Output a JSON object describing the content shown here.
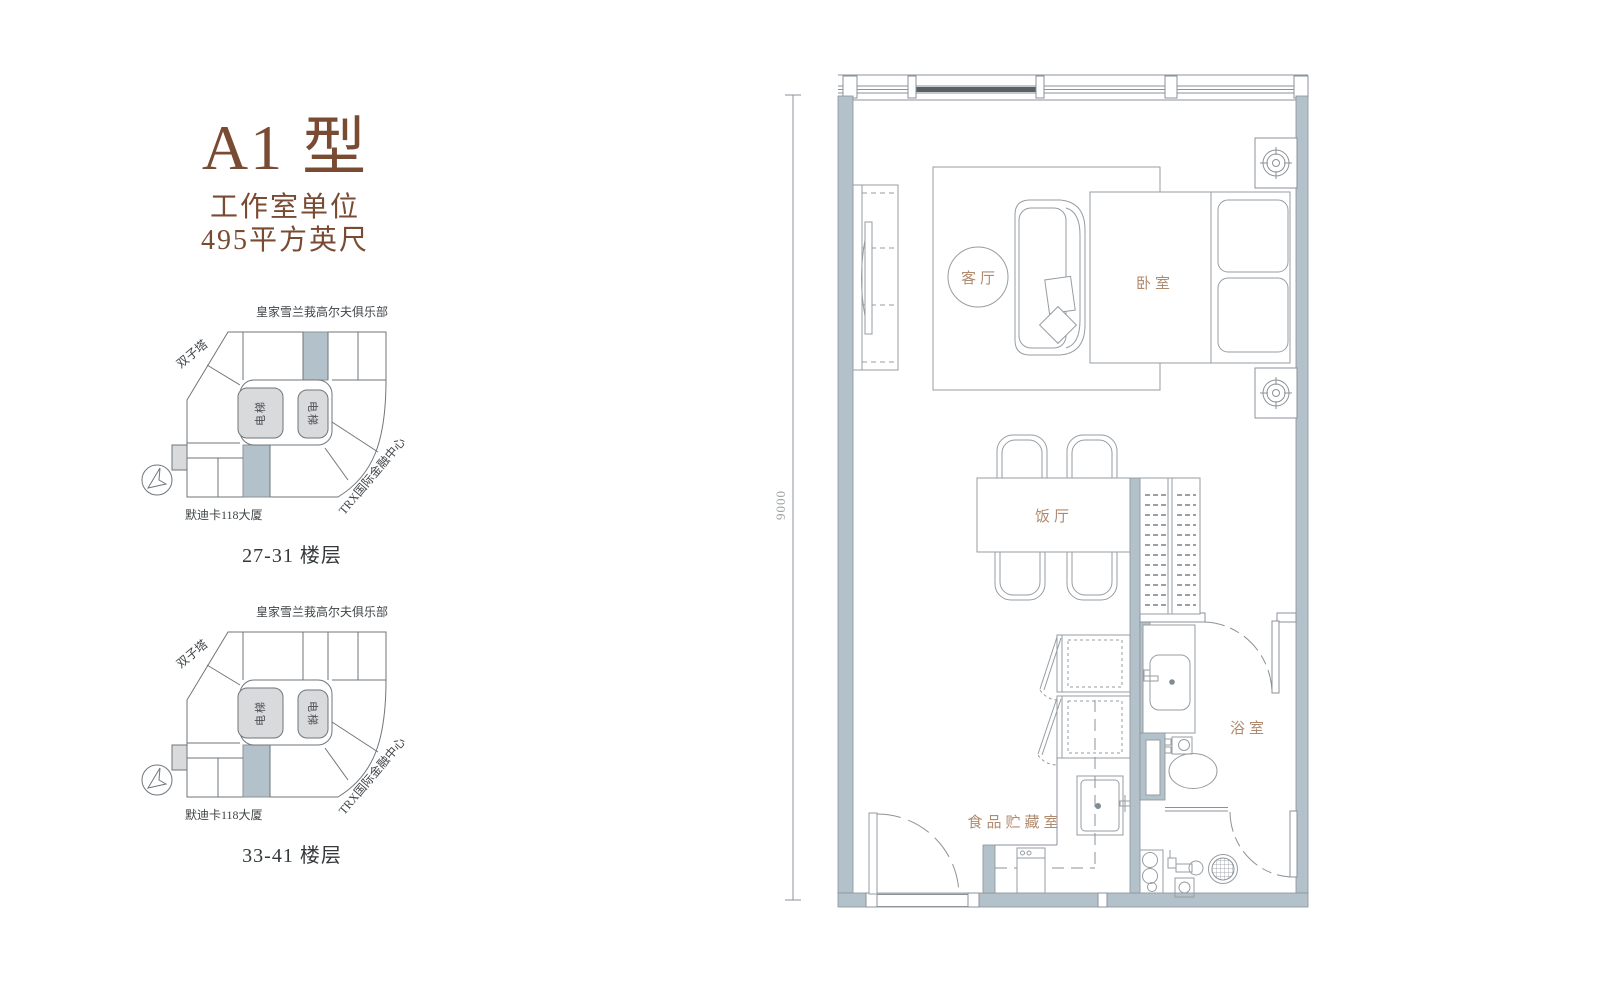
{
  "unit_panel": {
    "title": "A1 型",
    "type_label": "工作室单位",
    "area_label": "495平方英尺"
  },
  "key_plans": [
    {
      "floors_label": "27-31 楼层",
      "golf_label": "皇家雪兰莪高尔夫俱乐部",
      "twin_towers_label": "双子塔",
      "trx_label": "TRX国际金融中心",
      "merdeka_label": "默迪卡118大厦",
      "elevator_left_label": "电梯",
      "elevator_right_label": "电梯",
      "highlighted_units": [
        "top-middle",
        "bottom-middle"
      ]
    },
    {
      "floors_label": "33-41 楼层",
      "golf_label": "皇家雪兰莪高尔夫俱乐部",
      "twin_towers_label": "双子塔",
      "trx_label": "TRX国际金融中心",
      "merdeka_label": "默迪卡118大厦",
      "elevator_left_label": "电梯",
      "elevator_right_label": "电梯",
      "highlighted_units": [
        "bottom-middle"
      ]
    }
  ],
  "floor_plan": {
    "dimension_left": "9000",
    "rooms": {
      "living": "客厅",
      "bedroom": "卧室",
      "dining": "饭厅",
      "bathroom": "浴室",
      "pantry": "食品贮藏室"
    }
  },
  "colors": {
    "accent_brown": "#7a4b33",
    "room_label_brown": "#b08a6e",
    "wall_fill": "#b3c1ca",
    "line_gray": "#8b9298"
  }
}
